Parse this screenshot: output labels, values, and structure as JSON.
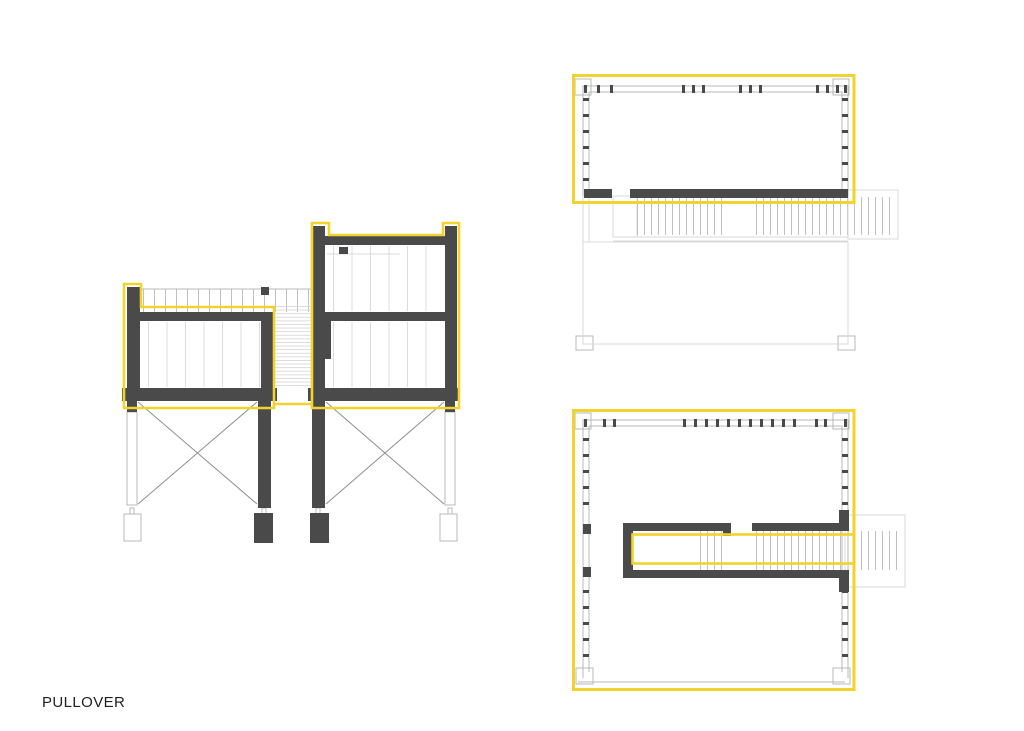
{
  "label": {
    "text": "PULLOVER"
  },
  "colors": {
    "background": "#ffffff",
    "highlight": "#F2D22C",
    "dark": "#4A4A4A",
    "line": "#B9B9B9",
    "faint": "#D9D9D9",
    "brace": "#909090",
    "text": "#1F1F1F"
  }
}
